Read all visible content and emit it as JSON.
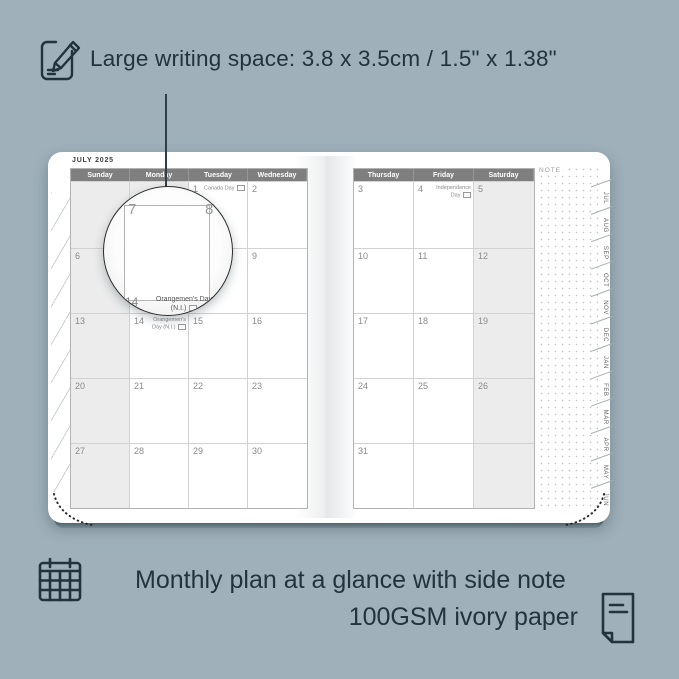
{
  "colors": {
    "background": "#9fb0ba",
    "ink": "#22333c",
    "header_gray": "#7f7f7f",
    "cell_shade": "#ececec",
    "page": "#ffffff"
  },
  "top_feature": {
    "text": "Large writing space: 3.8 x 3.5cm / 1.5\" x 1.38\""
  },
  "planner": {
    "month_title": "JULY 2025",
    "note_label": "NOTE",
    "left_headers": [
      "Sunday",
      "Monday",
      "Tuesday",
      "Wednesday"
    ],
    "right_headers": [
      "Thursday",
      "Friday",
      "Saturday"
    ],
    "left_cells": [
      [
        {
          "d": "",
          "s": true
        },
        {
          "d": "",
          "s": true
        },
        {
          "d": "1",
          "h": "Canada Day",
          "f": true
        },
        {
          "d": "2"
        }
      ],
      [
        {
          "d": "6",
          "s": true
        },
        {
          "d": "7"
        },
        {
          "d": "8"
        },
        {
          "d": "9"
        }
      ],
      [
        {
          "d": "13",
          "s": true
        },
        {
          "d": "14",
          "h": "Orangemen's Day (N.I.)",
          "f": true
        },
        {
          "d": "15"
        },
        {
          "d": "16"
        }
      ],
      [
        {
          "d": "20",
          "s": true
        },
        {
          "d": "21"
        },
        {
          "d": "22"
        },
        {
          "d": "23"
        }
      ],
      [
        {
          "d": "27",
          "s": true
        },
        {
          "d": "28"
        },
        {
          "d": "29"
        },
        {
          "d": "30"
        }
      ]
    ],
    "right_cells": [
      [
        {
          "d": "3"
        },
        {
          "d": "4",
          "h": "Independence Day",
          "f": true
        },
        {
          "d": "5",
          "s": true
        }
      ],
      [
        {
          "d": "10"
        },
        {
          "d": "11"
        },
        {
          "d": "12",
          "s": true
        }
      ],
      [
        {
          "d": "17"
        },
        {
          "d": "18"
        },
        {
          "d": "19",
          "s": true
        }
      ],
      [
        {
          "d": "24"
        },
        {
          "d": "25"
        },
        {
          "d": "26",
          "s": true
        }
      ],
      [
        {
          "d": "31"
        },
        {
          "d": ""
        },
        {
          "d": "",
          "s": true
        }
      ]
    ],
    "tabs": [
      "JUL",
      "AUG",
      "SEP",
      "OCT",
      "NOV",
      "DEC",
      "JAN",
      "FEB",
      "MAR",
      "APR",
      "MAY",
      "JUN"
    ]
  },
  "magnifier": {
    "day_left": "7",
    "day_right": "8",
    "day_bottom": "14",
    "holiday_line1": "Orangemen's Day",
    "holiday_line2": "(N.I.)"
  },
  "bottom_feature": {
    "line1": "Monthly plan at a glance with side note",
    "line2": "100GSM ivory paper"
  }
}
